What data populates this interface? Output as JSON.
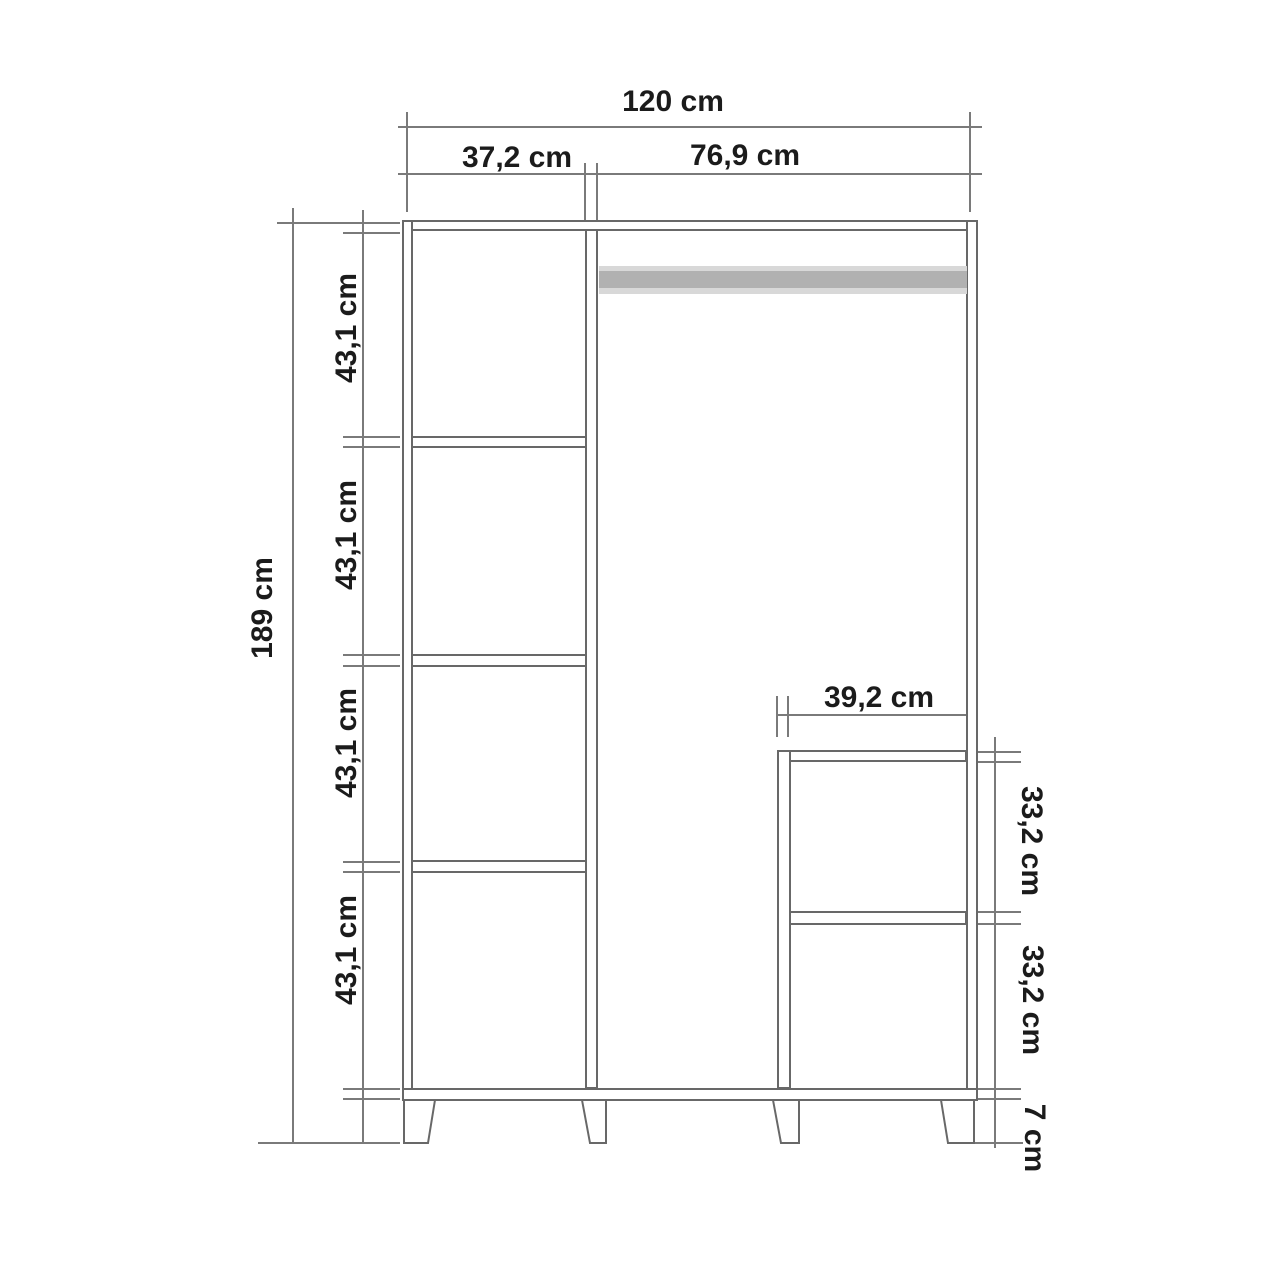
{
  "diagram": {
    "type": "furniture-technical-drawing",
    "subject": "wardrobe front elevation with outer and inner dimensions",
    "unit": "cm",
    "parts": [
      "outer carcass",
      "left shelf column with 4 compartments",
      "hanging rail",
      "bottom-right compartment with middle shelf",
      "4 tapered legs"
    ]
  },
  "labels": {
    "total_width": "120 cm",
    "left_column_width": "37,2 cm",
    "right_section_width": "76,9 cm",
    "total_height": "189 cm",
    "left_sections": [
      "43,1 cm",
      "43,1 cm",
      "43,1 cm",
      "43,1 cm"
    ],
    "sub_width": "39,2 cm",
    "sub_sections": [
      "33,2 cm",
      "33,2 cm"
    ],
    "leg_height": "7 cm"
  },
  "values_cm": {
    "total_width": 120,
    "left_column_width": 37.2,
    "right_section_width": 76.9,
    "total_height": 189,
    "left_section_height": 43.1,
    "sub_compartment_width": 39.2,
    "sub_section_height": 33.2,
    "leg_height": 7
  },
  "colors": {
    "background": "#ffffff",
    "panel_line": "#686868",
    "dimension_line": "#7a7a7a",
    "text": "#1b1b1b",
    "rail_fill": "#b1b1b1",
    "rail_edge": "#d8d8d8"
  }
}
